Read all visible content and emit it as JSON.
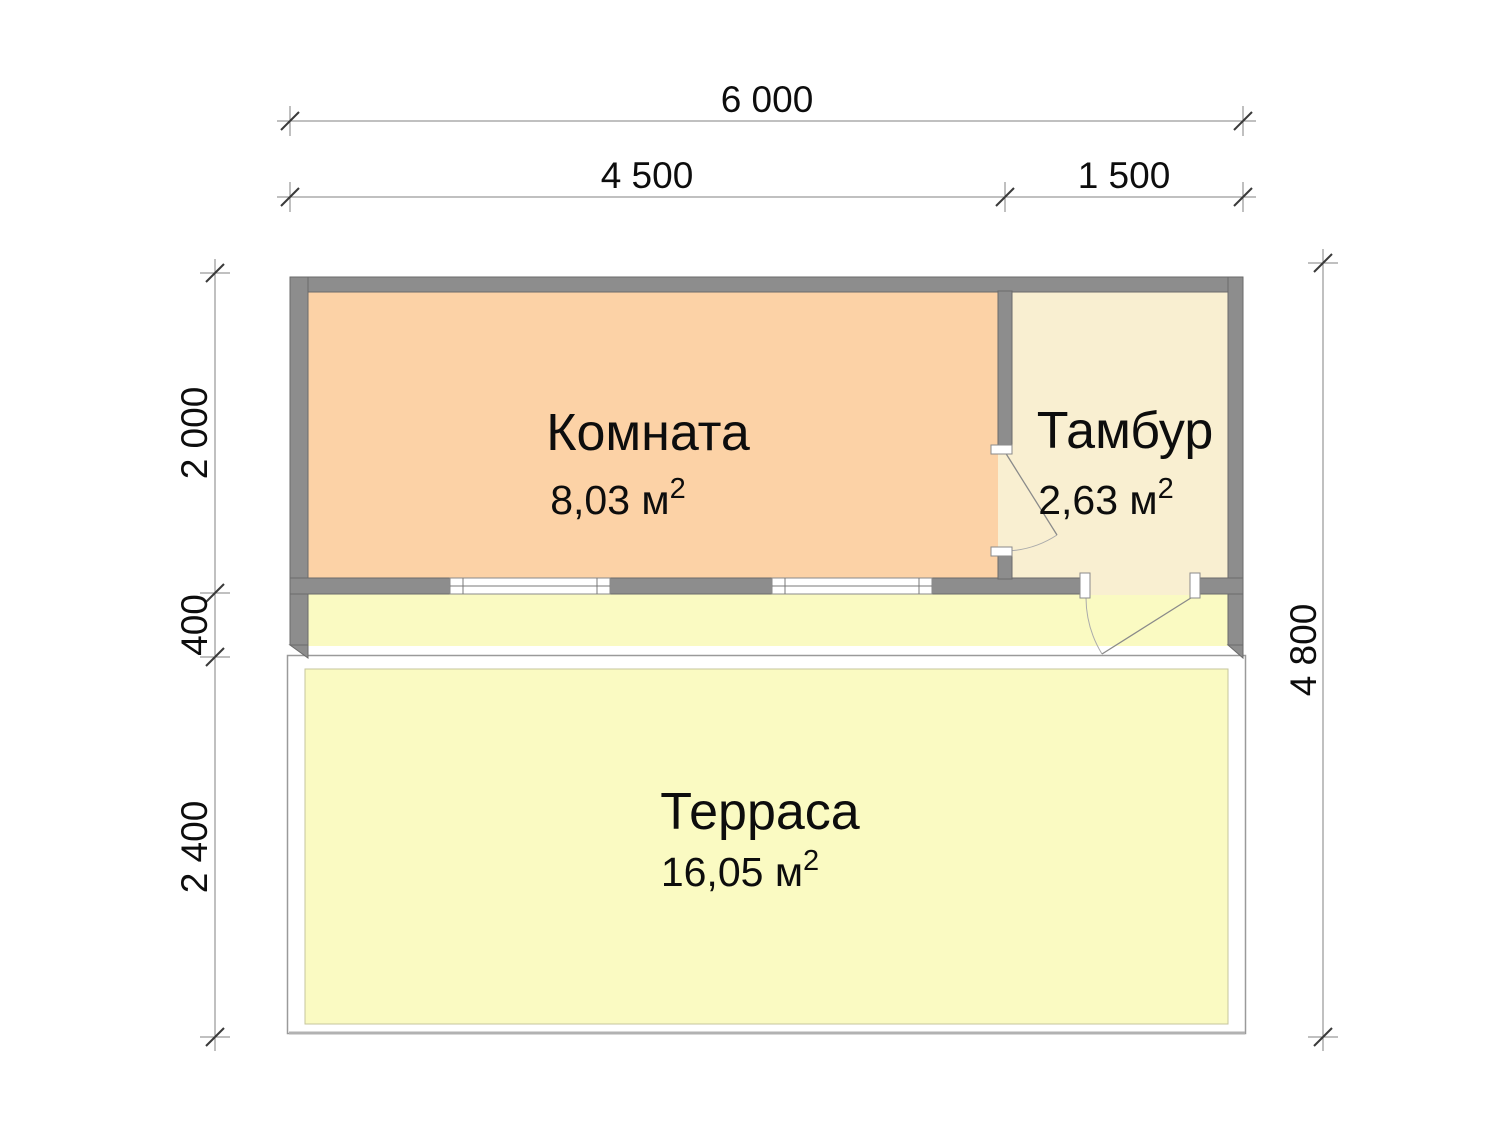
{
  "plan_title": "Floor plan with dimensions",
  "rooms": [
    {
      "name": "Комната",
      "area": "8,03 м",
      "area_sup": "2"
    },
    {
      "name": "Тамбур",
      "area": "2,63 м",
      "area_sup": "2"
    },
    {
      "name": "Терраса",
      "area": "16,05 м",
      "area_sup": "2"
    }
  ],
  "dimensions": {
    "top_total": "6 000",
    "top_left": "4 500",
    "top_right": "1 500",
    "left_room": "2 000",
    "left_porch": "400",
    "left_terrace": "2 400",
    "right_total": "4 800"
  },
  "colors": {
    "room-fill": "#fcd2a6",
    "vestibule-fill": "#f9efd1",
    "terrace-fill": "#fafac2",
    "wall-fill": "#8d8d8d",
    "wall-edge": "#6a6a6a",
    "outline": "#9a9a9a",
    "dim-line": "#808080",
    "dim-slash": "#3a3a3a",
    "dim-text": "#0d0d0d"
  }
}
